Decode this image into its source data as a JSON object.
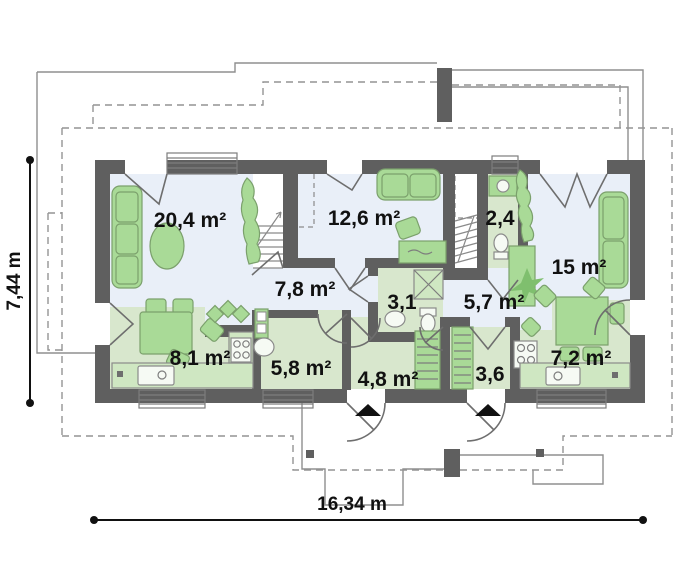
{
  "plan": {
    "type": "floor-plan",
    "rooms": [
      {
        "name": "living-room",
        "label": "20,4 m²"
      },
      {
        "name": "bedroom",
        "label": "12,6 m²"
      },
      {
        "name": "wc",
        "label": "2,4"
      },
      {
        "name": "sitting-room",
        "label": "15 m²"
      },
      {
        "name": "hall",
        "label": "7,8 m²"
      },
      {
        "name": "bathroom",
        "label": "3,1"
      },
      {
        "name": "hall-2",
        "label": "5,7 m²"
      },
      {
        "name": "kitchen-dining",
        "label": "8,1 m²"
      },
      {
        "name": "utility-room",
        "label": "5,8 m²"
      },
      {
        "name": "entry-hall",
        "label": "4,8 m²"
      },
      {
        "name": "entry-hall-2",
        "label": "3,6"
      },
      {
        "name": "kitchen",
        "label": "7,2 m²"
      }
    ],
    "dimensions": {
      "height": "7,44 m",
      "width": "16,34 m"
    },
    "colors": {
      "wall": "#5f5f5f",
      "floor_light": "#e9eff8",
      "floor_green": "#d8e7cd",
      "furniture_green": "#a9da97",
      "outline_gray": "#8f8f8f",
      "text": "#111111",
      "background": "#ffffff"
    }
  }
}
